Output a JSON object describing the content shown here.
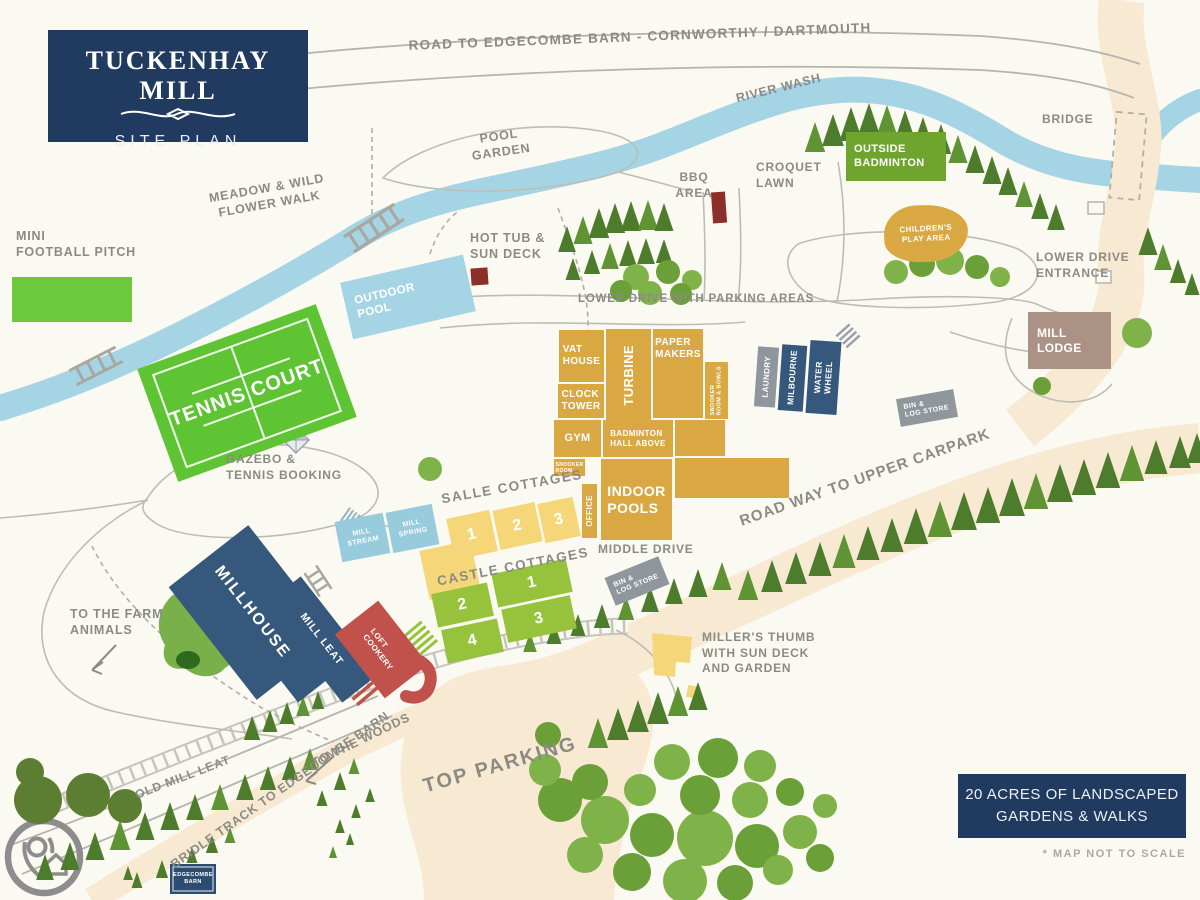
{
  "logo": {
    "title": "TUCKENHAY MILL",
    "subtitle": "SITE PLAN"
  },
  "labels": {
    "top_road": "ROAD TO EDGECOMBE BARN - CORNWORTHY / DARTMOUTH",
    "river_wash": "RIVER WASH",
    "bridge": "BRIDGE",
    "pool_garden": "POOL\nGARDEN",
    "meadow": "MEADOW & WILD\nFLOWER WALK",
    "mini_football": "MINI\nFOOTBALL PITCH",
    "hot_tub": "HOT TUB &\nSUN DECK",
    "bbq": "BBQ\nAREA",
    "croquet": "CROQUET\nLAWN",
    "lower_drive_entrance": "LOWER DRIVE\nENTRANCE",
    "lower_drive_parking": "LOWER DRIVE WITH PARKING AREAS",
    "road_upper_carpark": "ROAD WAY TO UPPER CARPARK",
    "gazebo": "GAZEBO &\nTENNIS BOOKING",
    "to_farm": "TO THE FARM\nANIMALS",
    "middle_drive": "MIDDLE DRIVE",
    "salle": "SALLE COTTAGES",
    "castle": "CASTLE COTTAGES",
    "millers_thumb": "MILLER'S THUMB\nWITH SUN DECK\nAND GARDEN",
    "to_woods": "TO THE WOODS",
    "old_mill_leat": "OLD MILL LEAT",
    "bridle_track": "BRIDLE TRACK TO EDGECOMBE BARN",
    "top_parking": "TOP PARKING"
  },
  "buildings": {
    "vat_house": "VAT\nHOUSE",
    "turbine": "TURBINE",
    "paper_makers": "PAPER\nMAKERS",
    "snooker_bowls": "SNOOKER\nROOM & BOWLS",
    "clock_tower": "CLOCK\nTOWER",
    "gym": "GYM",
    "badminton_hall": "BADMINTON\nHALL ABOVE",
    "snooker_room": "SNOOKER\nROOM",
    "indoor_pools": "INDOOR\nPOOLS",
    "office": "OFFICE",
    "laundry": "LAUNDRY",
    "milbourne": "MILBOURNE",
    "water_wheel": "WATER\nWHEEL",
    "bin_log": "BIN &\nLOG STORE",
    "mill_lodge": "MILL\nLODGE",
    "outside_badminton": "OUTSIDE\nBADMINTON",
    "childrens_play": "CHILDREN'S\nPLAY AREA",
    "outdoor_pool": "OUTDOOR\nPOOL",
    "tennis_court": "TENNIS COURT",
    "mill_stream": "MILL\nSTREAM",
    "mill_spring": "MILL\nSPRING",
    "millhouse": "MILLHOUSE",
    "mill_leat": "MILL LEAT",
    "cookery_loft": "COOKERY\nLOFT",
    "edgecombe_barn": "EDGECOMBE\nBARN"
  },
  "cottage_numbers": {
    "salle": [
      "1",
      "2",
      "3"
    ],
    "castle_row1": [
      "2",
      "1"
    ],
    "castle_row2": [
      "4",
      "3"
    ]
  },
  "footer": {
    "line": "20 ACRES OF LANDSCAPED\nGARDENS & WALKS",
    "note": "* MAP NOT TO SCALE"
  },
  "colors": {
    "navy": "#203a60",
    "gold": "#d9a843",
    "yellow": "#f5d77a",
    "cottage_green": "#97c23c",
    "bright_green": "#5ec433",
    "pitch_green": "#6cc93c",
    "badminton_green": "#6fa42e",
    "river_blue": "#a5d5e5",
    "stream_blue": "#98cbdc",
    "building_navy": "#36587c",
    "gray": "#8f969c",
    "lodge_taupe": "#ab9284",
    "red": "#c0524b",
    "dark_red": "#8c2f28",
    "road_beige": "#f8e9d2",
    "label_gray": "#8b8b84",
    "conifer": "#4d7c2c",
    "conifer_light": "#5f9334",
    "bush": [
      "#7fb34a",
      "#6b9f38",
      "#5c7e33"
    ]
  },
  "decor": {
    "conifers": [
      [
        815,
        152,
        30
      ],
      [
        833,
        146,
        32
      ],
      [
        851,
        141,
        34
      ],
      [
        869,
        139,
        36
      ],
      [
        887,
        139,
        34
      ],
      [
        905,
        142,
        32
      ],
      [
        923,
        147,
        30
      ],
      [
        941,
        154,
        30
      ],
      [
        958,
        163,
        28
      ],
      [
        975,
        173,
        28
      ],
      [
        992,
        184,
        28
      ],
      [
        1008,
        195,
        28
      ],
      [
        1024,
        207,
        26
      ],
      [
        1040,
        219,
        26
      ],
      [
        1056,
        230,
        26
      ],
      [
        1148,
        255,
        28
      ],
      [
        1163,
        270,
        26
      ],
      [
        1178,
        283,
        24
      ],
      [
        1192,
        295,
        22
      ],
      [
        567,
        252,
        26
      ],
      [
        583,
        244,
        28
      ],
      [
        599,
        238,
        30
      ],
      [
        615,
        233,
        30
      ],
      [
        631,
        231,
        30
      ],
      [
        648,
        230,
        30
      ],
      [
        664,
        231,
        28
      ],
      [
        573,
        280,
        22
      ],
      [
        592,
        274,
        24
      ],
      [
        610,
        269,
        26
      ],
      [
        628,
        266,
        26
      ],
      [
        646,
        264,
        26
      ],
      [
        664,
        263,
        24
      ],
      [
        748,
        600,
        30
      ],
      [
        772,
        592,
        32
      ],
      [
        796,
        584,
        32
      ],
      [
        820,
        576,
        34
      ],
      [
        844,
        568,
        34
      ],
      [
        868,
        560,
        34
      ],
      [
        892,
        552,
        34
      ],
      [
        916,
        544,
        36
      ],
      [
        940,
        537,
        36
      ],
      [
        964,
        530,
        38
      ],
      [
        988,
        523,
        36
      ],
      [
        1012,
        516,
        38
      ],
      [
        1036,
        509,
        36
      ],
      [
        1060,
        502,
        38
      ],
      [
        1084,
        495,
        36
      ],
      [
        1108,
        488,
        36
      ],
      [
        1132,
        481,
        36
      ],
      [
        1156,
        474,
        34
      ],
      [
        1180,
        468,
        32
      ],
      [
        1197,
        463,
        30
      ],
      [
        530,
        652,
        20
      ],
      [
        554,
        644,
        22
      ],
      [
        578,
        636,
        22
      ],
      [
        602,
        628,
        24
      ],
      [
        626,
        620,
        24
      ],
      [
        650,
        612,
        26
      ],
      [
        674,
        604,
        26
      ],
      [
        698,
        597,
        28
      ],
      [
        722,
        590,
        28
      ],
      [
        45,
        880,
        26
      ],
      [
        70,
        870,
        28
      ],
      [
        95,
        860,
        28
      ],
      [
        120,
        850,
        30
      ],
      [
        145,
        840,
        28
      ],
      [
        170,
        830,
        28
      ],
      [
        195,
        820,
        26
      ],
      [
        220,
        810,
        26
      ],
      [
        245,
        800,
        26
      ],
      [
        268,
        790,
        24
      ],
      [
        290,
        780,
        24
      ],
      [
        310,
        770,
        22
      ],
      [
        252,
        740,
        24
      ],
      [
        270,
        732,
        22
      ],
      [
        287,
        724,
        22
      ],
      [
        303,
        716,
        20
      ],
      [
        318,
        709,
        18
      ],
      [
        322,
        806,
        16
      ],
      [
        340,
        790,
        18
      ],
      [
        354,
        774,
        16
      ],
      [
        340,
        833,
        14
      ],
      [
        356,
        818,
        14
      ],
      [
        370,
        802,
        14
      ],
      [
        333,
        858,
        12
      ],
      [
        350,
        845,
        12
      ],
      [
        212,
        853,
        18
      ],
      [
        192,
        863,
        16
      ],
      [
        230,
        843,
        16
      ],
      [
        162,
        878,
        18
      ],
      [
        137,
        888,
        16
      ],
      [
        128,
        880,
        14
      ],
      [
        598,
        748,
        30
      ],
      [
        618,
        740,
        32
      ],
      [
        638,
        732,
        32
      ],
      [
        658,
        724,
        32
      ],
      [
        678,
        716,
        30
      ],
      [
        698,
        710,
        28
      ]
    ],
    "bushes": [
      [
        636,
        277,
        13,
        0
      ],
      [
        668,
        272,
        12,
        1
      ],
      [
        692,
        280,
        10,
        0
      ],
      [
        621,
        291,
        11,
        1
      ],
      [
        650,
        293,
        12,
        0
      ],
      [
        681,
        294,
        11,
        1
      ],
      [
        896,
        272,
        12,
        0
      ],
      [
        922,
        264,
        13,
        1
      ],
      [
        950,
        261,
        14,
        0
      ],
      [
        977,
        267,
        12,
        1
      ],
      [
        1000,
        277,
        10,
        0
      ],
      [
        1137,
        333,
        15,
        0
      ],
      [
        1042,
        386,
        9,
        1
      ],
      [
        430,
        469,
        12,
        0
      ],
      [
        560,
        800,
        22,
        1
      ],
      [
        605,
        820,
        24,
        0
      ],
      [
        652,
        835,
        22,
        1
      ],
      [
        705,
        838,
        28,
        0
      ],
      [
        757,
        846,
        22,
        1
      ],
      [
        800,
        832,
        17,
        0
      ],
      [
        585,
        855,
        18,
        0
      ],
      [
        632,
        872,
        19,
        1
      ],
      [
        685,
        881,
        22,
        0
      ],
      [
        735,
        883,
        18,
        1
      ],
      [
        778,
        870,
        15,
        0
      ],
      [
        820,
        858,
        14,
        1
      ],
      [
        545,
        770,
        16,
        0
      ],
      [
        590,
        782,
        18,
        1
      ],
      [
        640,
        790,
        16,
        0
      ],
      [
        700,
        795,
        20,
        1
      ],
      [
        750,
        800,
        18,
        0
      ],
      [
        790,
        792,
        14,
        1
      ],
      [
        825,
        806,
        12,
        0
      ],
      [
        718,
        758,
        20,
        1
      ],
      [
        760,
        766,
        16,
        0
      ],
      [
        672,
        762,
        18,
        0
      ],
      [
        548,
        735,
        13,
        1
      ],
      [
        38,
        800,
        24,
        2
      ],
      [
        88,
        795,
        22,
        2
      ],
      [
        125,
        806,
        17,
        2
      ],
      [
        30,
        772,
        14,
        2
      ]
    ]
  }
}
